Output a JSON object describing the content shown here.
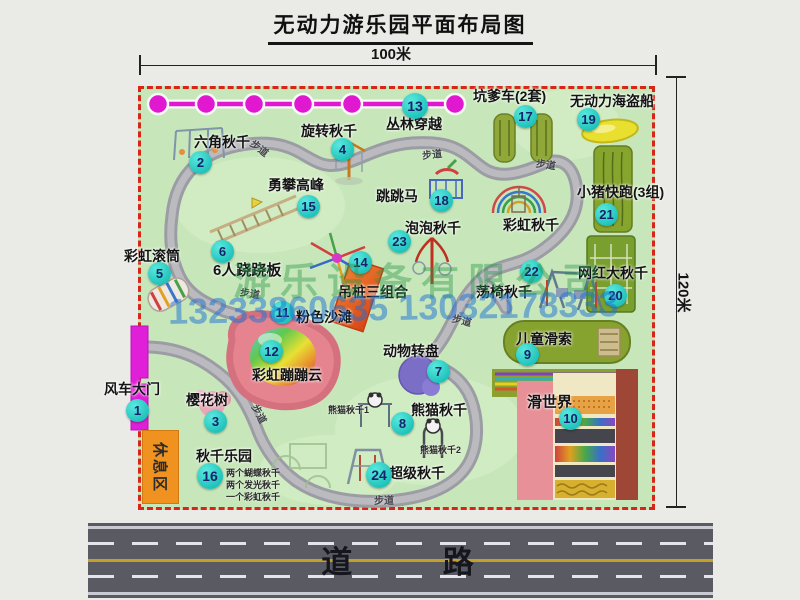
{
  "title": "无动力游乐园平面布局图",
  "dimensions": {
    "width": "100米",
    "height": "120米"
  },
  "road": {
    "label": "道 路"
  },
  "watermark": {
    "company": "游乐设备有限公司",
    "phone": "13233860635 13032178333"
  },
  "path_label": "步道",
  "rest_area_label": "休息区",
  "extra_labels": {
    "rainbow_swing": "彩虹秋千",
    "panda_swing_1": "熊猫秋千1",
    "panda_swing_2": "熊猫秋千2"
  },
  "swing_park_notes": [
    "两个蝴蝶秋千",
    "两个发光秋千",
    "一个彩虹秋千"
  ],
  "attractions": {
    "windmill_gate": {
      "num": "1",
      "label": "风车大门"
    },
    "hex_swing": {
      "num": "2",
      "label": "六角秋千"
    },
    "cherry_tree": {
      "num": "3",
      "label": "樱花树"
    },
    "rotary_swing": {
      "num": "4",
      "label": "旋转秋千"
    },
    "rainbow_roller": {
      "num": "5",
      "label": "彩虹滚筒"
    },
    "six_seesaw": {
      "num": "6",
      "label": "6人跷跷板"
    },
    "animal_wheel": {
      "num": "7",
      "label": "动物转盘"
    },
    "panda_swing": {
      "num": "8",
      "label": "熊猫秋千"
    },
    "kids_zipline": {
      "num": "9",
      "label": "儿童滑索"
    },
    "slide_world": {
      "num": "10",
      "label": "滑世界"
    },
    "pink_beach": {
      "num": "11",
      "label": "粉色沙滩"
    },
    "rainbow_cloud": {
      "num": "12",
      "label": "彩虹蹦蹦云"
    },
    "jungle_crossing": {
      "num": "13",
      "label": "丛林穿越"
    },
    "hanging_posts": {
      "num": "14",
      "label": "吊桩三组合"
    },
    "climbing_peak": {
      "num": "15",
      "label": "勇攀高峰"
    },
    "swing_park": {
      "num": "16",
      "label": "秋千乐园"
    },
    "kengdie_cars": {
      "num": "17",
      "label": "坑爹车(2套)"
    },
    "jumping_horse": {
      "num": "18",
      "label": "跳跳马"
    },
    "pirate_ship": {
      "num": "19",
      "label": "无动力海盗船"
    },
    "big_swing": {
      "num": "20",
      "label": "网红大秋千"
    },
    "piggy_run": {
      "num": "21",
      "label": "小猪快跑(3组)"
    },
    "chair_swing": {
      "num": "22",
      "label": "荡椅秋千"
    },
    "bubble_swing": {
      "num": "23",
      "label": "泡泡秋千"
    },
    "super_swing": {
      "num": "24",
      "label": "超级秋千"
    }
  }
}
